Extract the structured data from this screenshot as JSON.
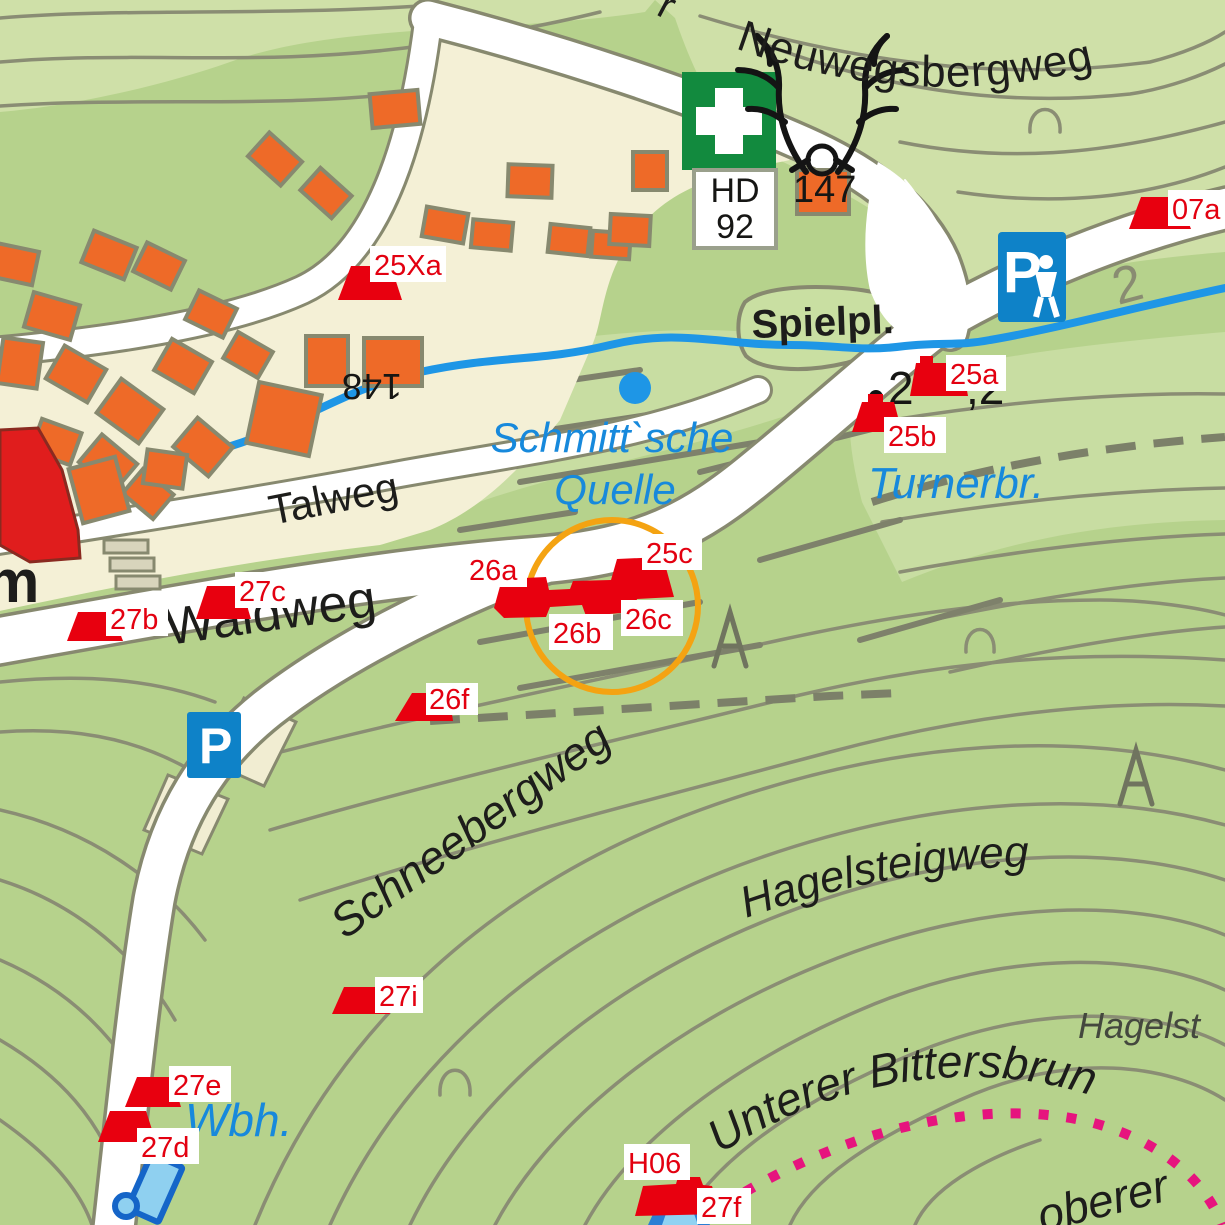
{
  "map_labels": {
    "streets": {
      "neuwegsbergweg": "Neuwegsbergweg",
      "neuweg_cut_prefix": "r",
      "talweg": "Talweg",
      "waldweg": "Waldweg",
      "schneebergweg": "Schneebergweg",
      "hagelsteigweg": "Hagelsteigweg",
      "unterer_bittersbrunnen": "Unterer Bittersbrun",
      "hagelst_cut": "Hagelst",
      "oberer_cut": "oberer",
      "m_cut": "m"
    },
    "water": {
      "quelle_line1": "Schmitt`sche",
      "quelle_line2": "Quelle",
      "turnerbruecke": "Turnerbr.",
      "wasserbehaelter": "Wbh."
    },
    "places": {
      "spielplatz": "Spielpl."
    },
    "numbers": {
      "n147": "147",
      "n148": "148",
      "contour_2": "2",
      "elevation_left": "2",
      "elevation_right": ",2"
    },
    "signs": {
      "first_aid_line1": "HD",
      "first_aid_line2": "92",
      "parking": "P",
      "parking_walk": "P"
    }
  },
  "markers": [
    {
      "id": "25Xa",
      "label": "25Xa"
    },
    {
      "id": "07a",
      "label": "07a"
    },
    {
      "id": "25a",
      "label": "25a"
    },
    {
      "id": "25b",
      "label": "25b"
    },
    {
      "id": "25c",
      "label": "25c"
    },
    {
      "id": "26a",
      "label": "26a"
    },
    {
      "id": "26b",
      "label": "26b"
    },
    {
      "id": "26c",
      "label": "26c"
    },
    {
      "id": "26f",
      "label": "26f"
    },
    {
      "id": "27b",
      "label": "27b"
    },
    {
      "id": "27c",
      "label": "27c"
    },
    {
      "id": "27i",
      "label": "27i"
    },
    {
      "id": "27e",
      "label": "27e"
    },
    {
      "id": "27d",
      "label": "27d"
    },
    {
      "id": "H06",
      "label": "H06"
    },
    {
      "id": "27f",
      "label": "27f"
    }
  ],
  "colors": {
    "marker_red": "#e8000f",
    "marker_label_red": "#e30010",
    "highlight_circle_orange": "#f4a312",
    "stream_blue": "#1e96e6",
    "water_label_blue": "#1789dc",
    "forest_green": "#b6d28c",
    "pale_green": "#cfe0a8",
    "urban_cream": "#f4f0d6",
    "building_orange": "#ee6a28",
    "landmark_red": "#e01d1d",
    "road_white": "#ffffff",
    "outline_gray": "#87896f",
    "boundary_pink": "#e6147e",
    "first_aid_green": "#128a3e",
    "parking_blue": "#0e82c8"
  }
}
